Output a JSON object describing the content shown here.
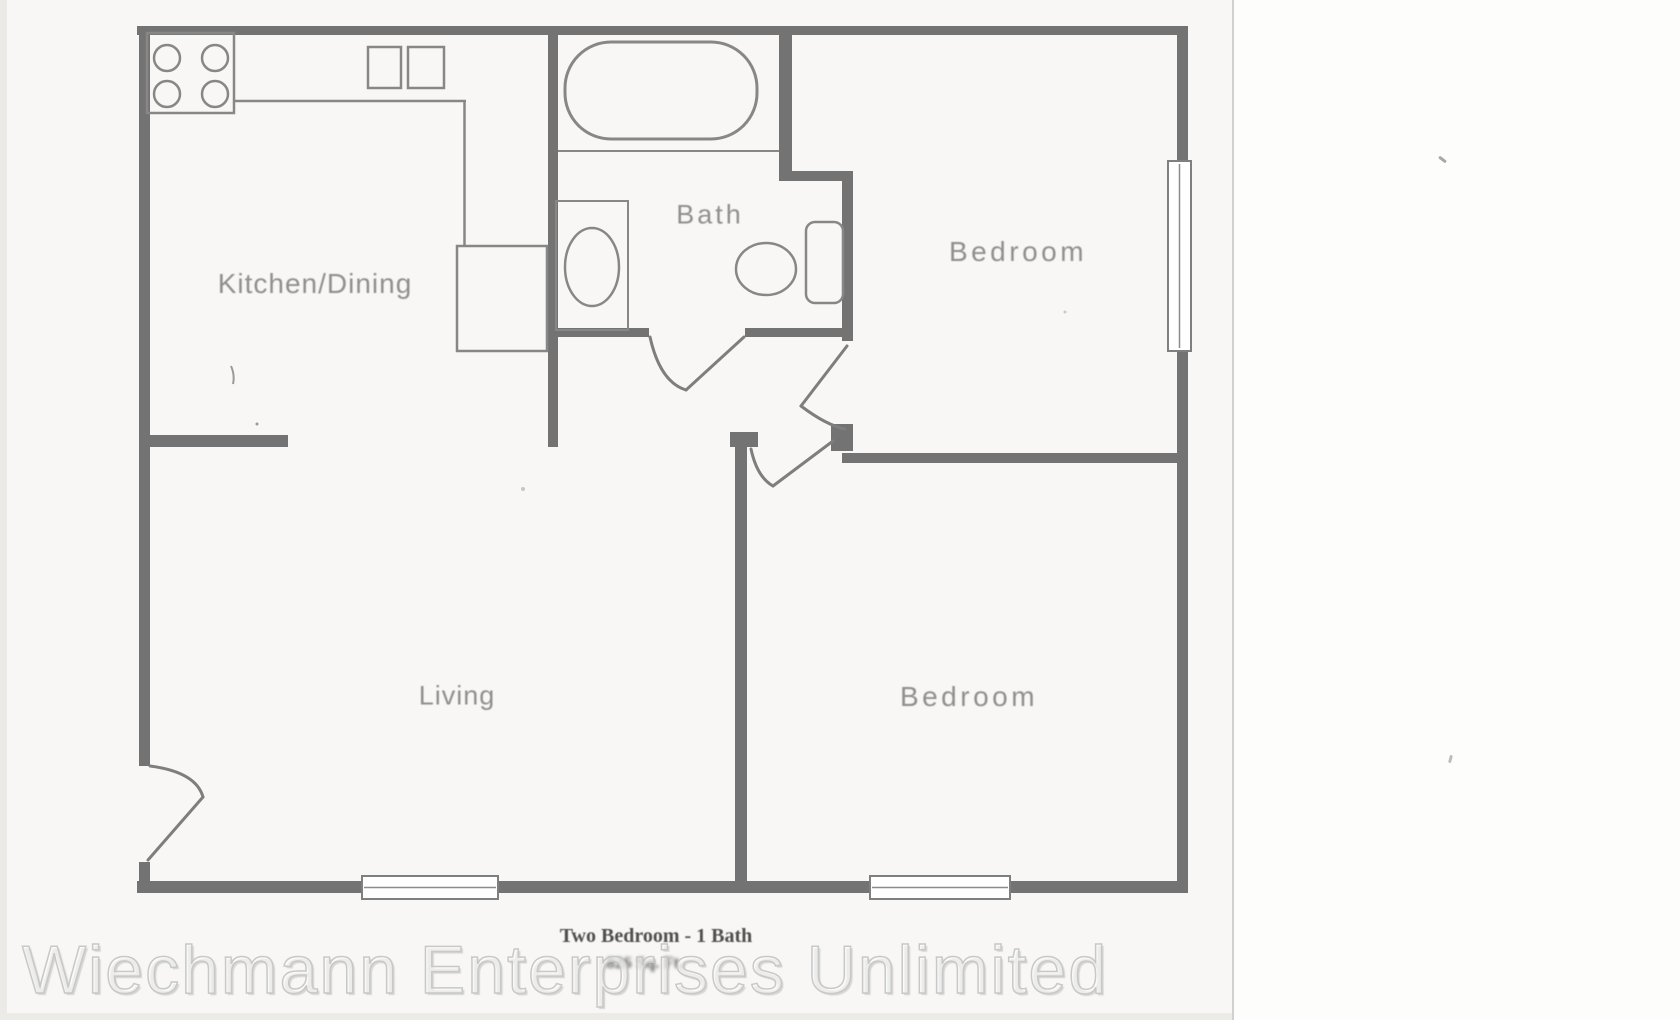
{
  "plan": {
    "labels": {
      "kitchen_dining": "Kitchen/Dining",
      "bath": "Bath",
      "bedroom_top": "Bedroom",
      "living": "Living",
      "bedroom_bottom": "Bedroom"
    },
    "caption": {
      "line1": "Two Bedroom - 1 Bath",
      "line2": "826 Sq. Ft."
    }
  },
  "watermark": "Wiechmann Enterprises Unlimited",
  "colors": {
    "wall": "#737373",
    "fixture_line": "#878787",
    "door_line": "#7e7e7e",
    "label_text": "#8f8f8f",
    "caption_text": "#4f4f4f",
    "watermark_outline": "#c8c8c8",
    "paper": "#f8f7f5",
    "right_panel": "#fdfdfc"
  }
}
